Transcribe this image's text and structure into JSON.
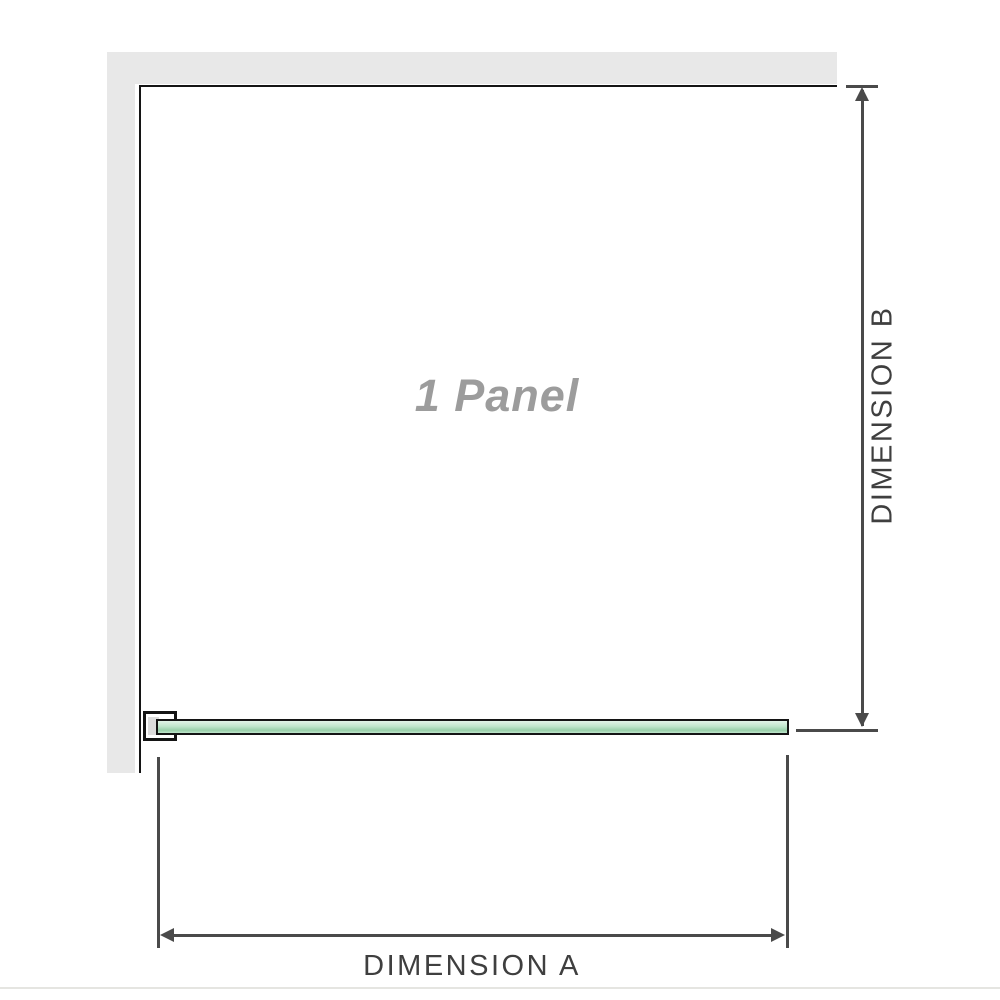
{
  "diagram": {
    "title": "1 Panel shower screen installation diagram",
    "panel_label": "1 Panel",
    "dimension_a": {
      "label": "DIMENSION A",
      "orientation": "horizontal"
    },
    "dimension_b": {
      "label": "DIMENSION B",
      "orientation": "vertical"
    },
    "parts": {
      "wall": "wall (plan view, L-shaped)",
      "glass": "glass panel (plan view)",
      "bracket": "wall mounting bracket"
    }
  },
  "colors": {
    "wall": "#e8e8e8",
    "outline": "#141414",
    "dimension": "#4a4a4a",
    "glass_fill": "#bfe5cb",
    "glass_highlight": "#e2f3e8",
    "glass_shade": "#98cfa9",
    "label_muted": "#9c9c9c",
    "label_dark": "#3f3f3f",
    "separator": "#e5e5e1"
  }
}
